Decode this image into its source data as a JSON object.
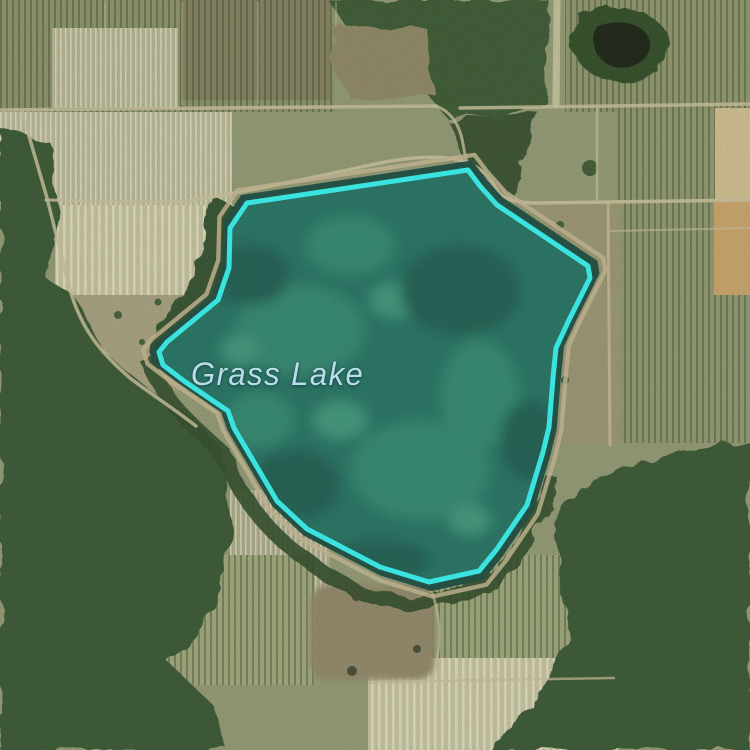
{
  "map": {
    "view_type": "satellite",
    "label": {
      "text": "Grass Lake",
      "color": "#b9dde9"
    },
    "overlay": {
      "name": "lake-boundary",
      "stroke_color": "#3be3e0",
      "stroke_width": 5,
      "fill_color": "rgba(62,227,224,0.07)",
      "points": "468,170 247,203 230,228 229,268 218,300 167,342 159,352 163,365 184,381 228,411 234,428 277,501 307,529 380,567 429,582 479,571 497,549 527,505 543,452 549,427 553,378 556,348 568,322 590,278 588,266 497,205 480,186"
    },
    "terrain_colors": {
      "water": "#1e6355",
      "field": "#8e9370",
      "forest": "#35512e",
      "road": "#c6bb99"
    }
  }
}
